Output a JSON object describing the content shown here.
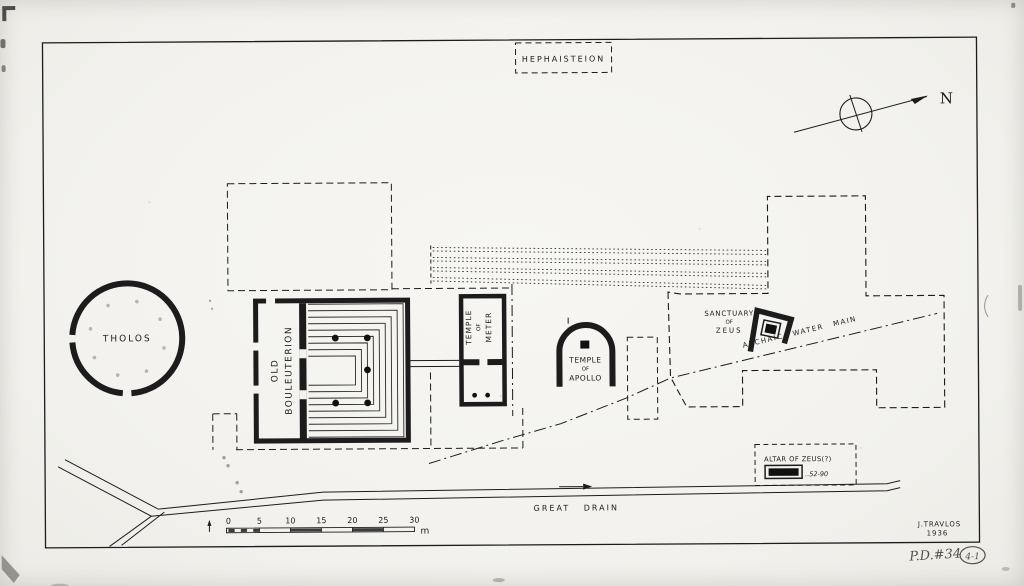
{
  "drawing": {
    "title_box": {
      "label": "HEPHAISTEION"
    },
    "compass": {
      "north_label": "N"
    },
    "buildings": {
      "tholos": "THOLOS",
      "bouleuterion_line1": "OLD",
      "bouleuterion_line2": "BOULEUTERION",
      "meter_line1": "TEMPLE",
      "meter_line2": "OF",
      "meter_line3": "METER",
      "apollo_line1": "TEMPLE",
      "apollo_line2": "OF",
      "apollo_line3": "APOLLO",
      "zeus_line1": "SANCTUARY",
      "zeus_line2": "OF",
      "zeus_line3": "ZEUS"
    },
    "features": {
      "water_main": "ARCHAIC WATER MAIN",
      "altar_label": "ALTAR OF ZEUS(?)",
      "altar_note": "..52-90",
      "great_drain": "GREAT DRAIN"
    },
    "scale": {
      "ticks": [
        "0",
        "5",
        "10",
        "15",
        "20",
        "25",
        "30"
      ],
      "unit": "m"
    },
    "credit": {
      "author": "J.TRAVLOS",
      "year": "1936"
    },
    "annotations": {
      "pd_number": "P.D.#34",
      "circled": "4-1"
    },
    "colors": {
      "ink": "#1c1c1c",
      "paper": "#f4f3ef",
      "pencil": "#55524c"
    }
  }
}
